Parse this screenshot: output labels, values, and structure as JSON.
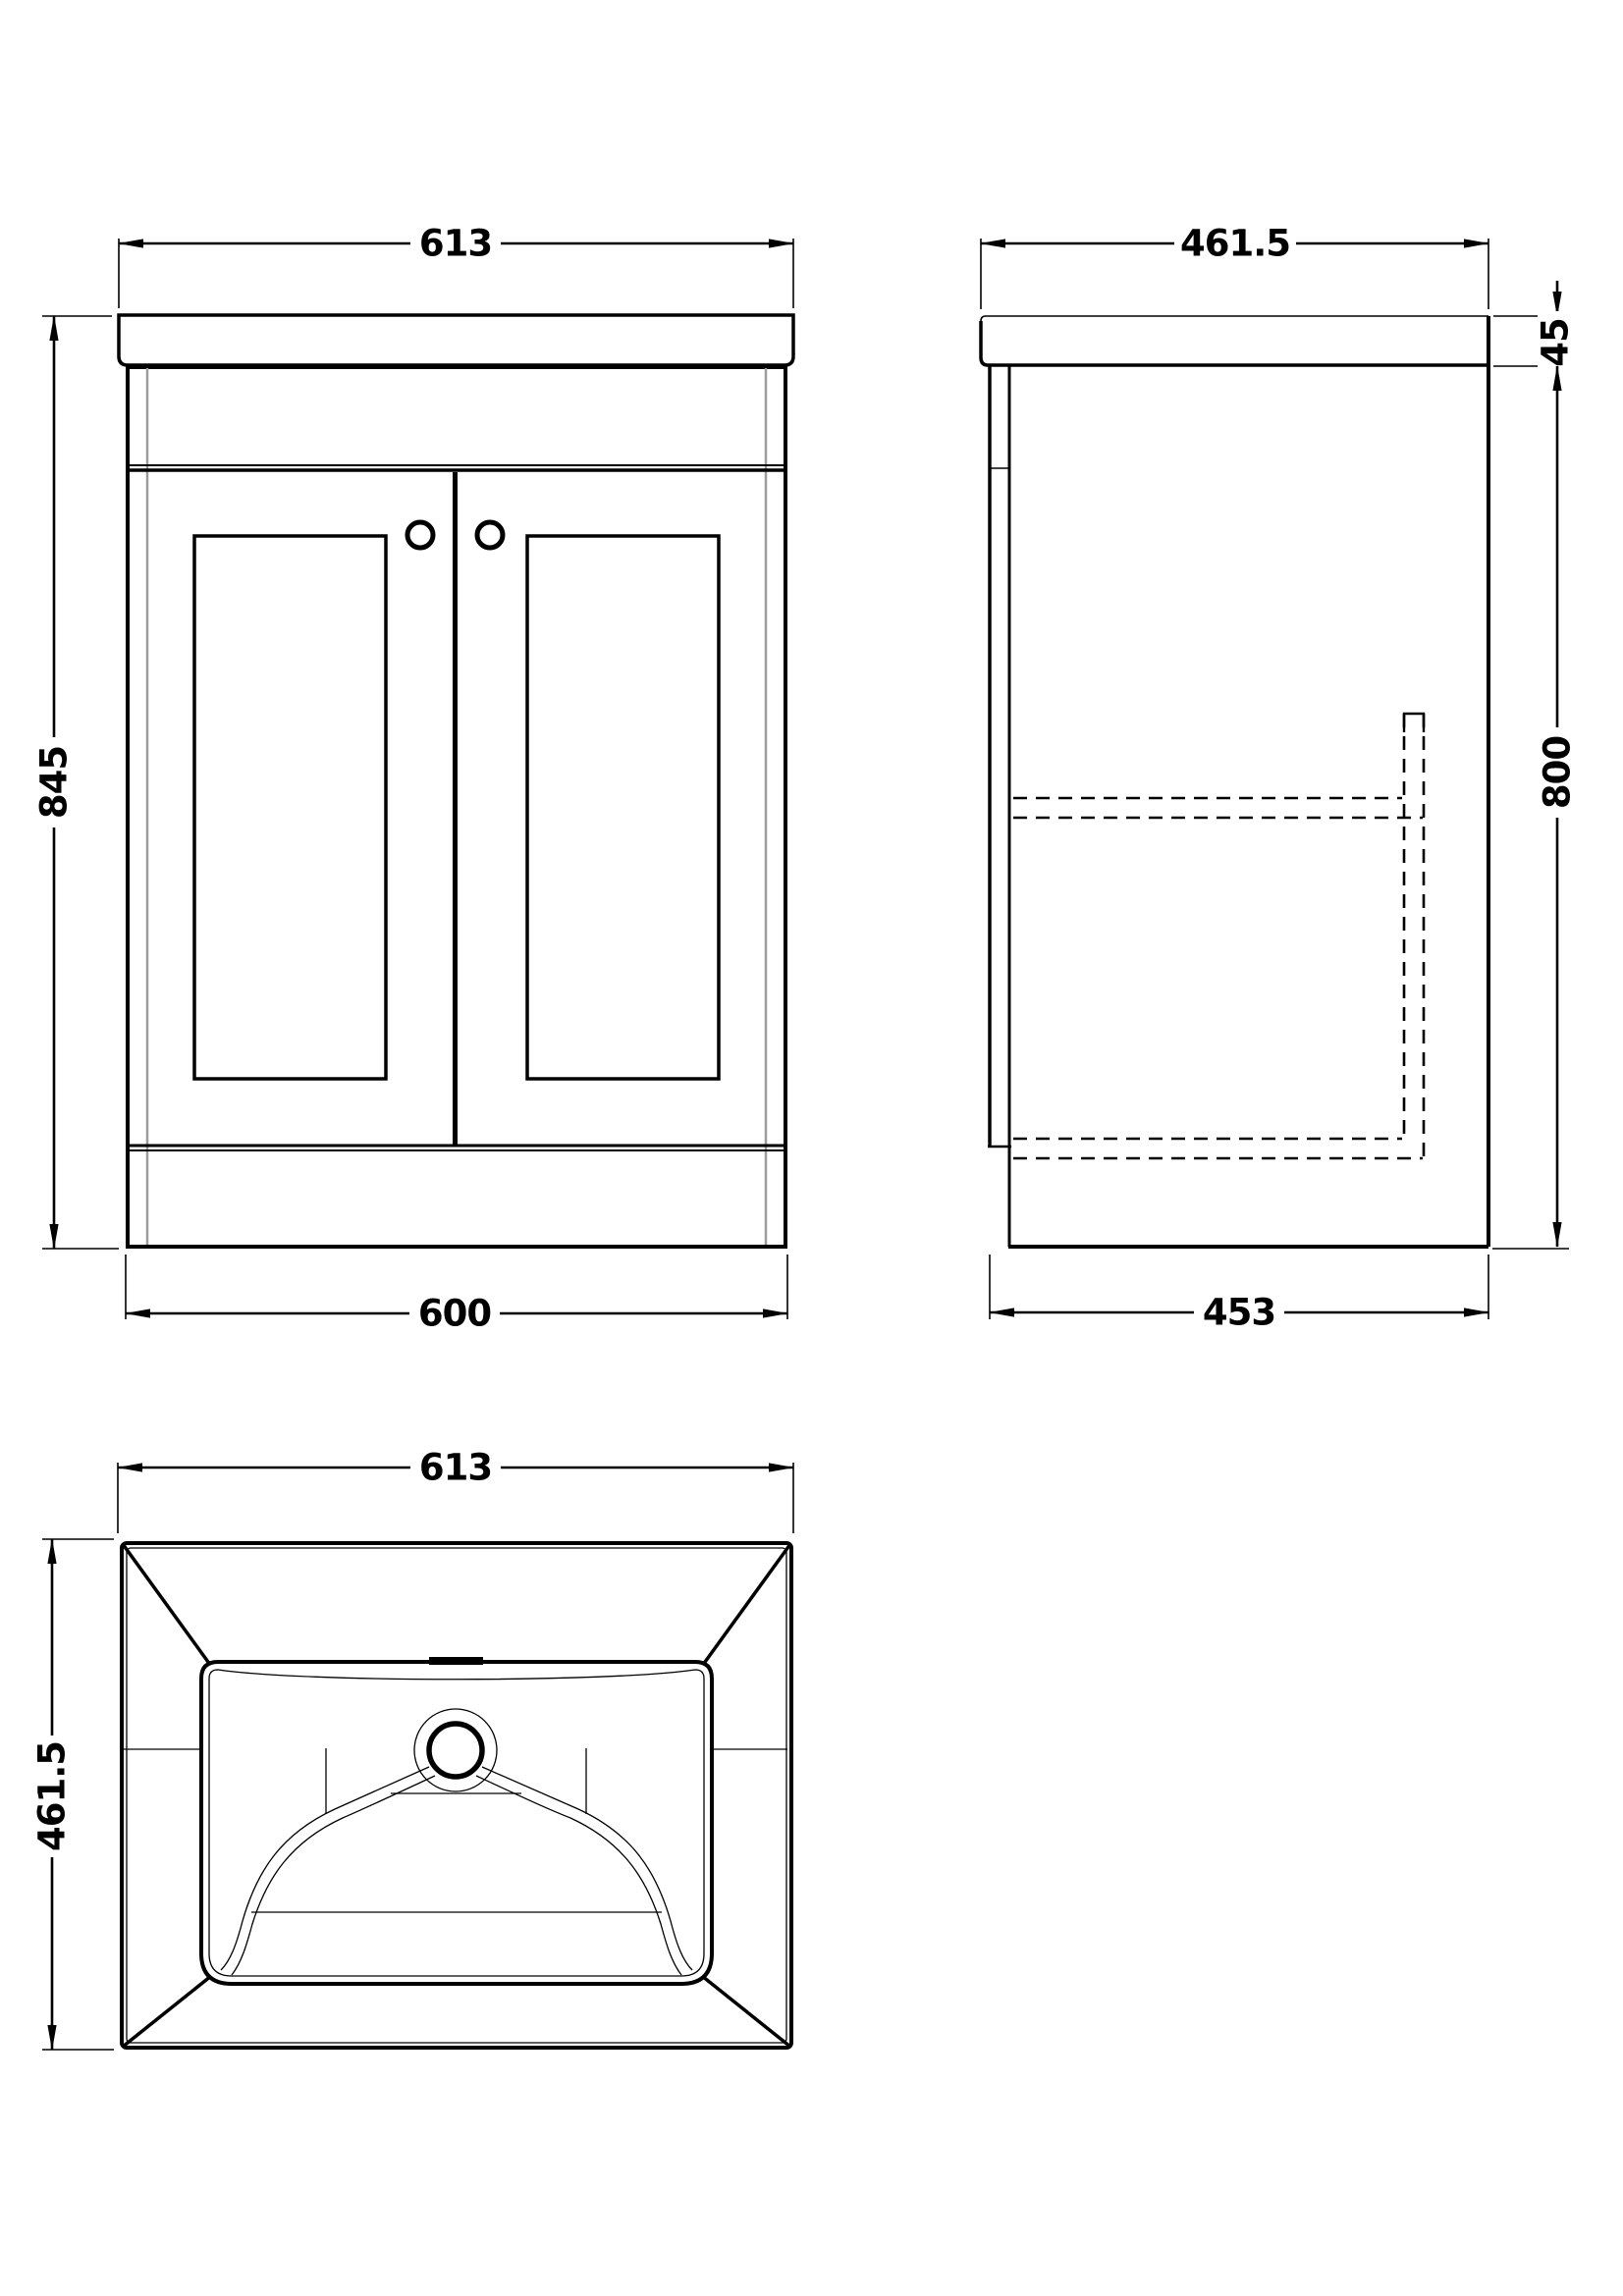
{
  "title": "Vanity unit with basin - dimensioned technical drawing",
  "views": {
    "front": {
      "label": "front view",
      "dim_width_top": "613",
      "dim_height": "845",
      "dim_width_bottom": "600"
    },
    "side": {
      "label": "side view",
      "dim_depth_top": "461.5",
      "dim_worktop_thickness": "45",
      "dim_body_height": "800",
      "dim_depth_bottom": "453"
    },
    "plan": {
      "label": "plan view of basin",
      "dim_width": "613",
      "dim_depth": "461.5"
    }
  },
  "colors": {
    "line": "#000000",
    "hidden_line_gray": "#9b9b9b",
    "background": "#ffffff"
  }
}
